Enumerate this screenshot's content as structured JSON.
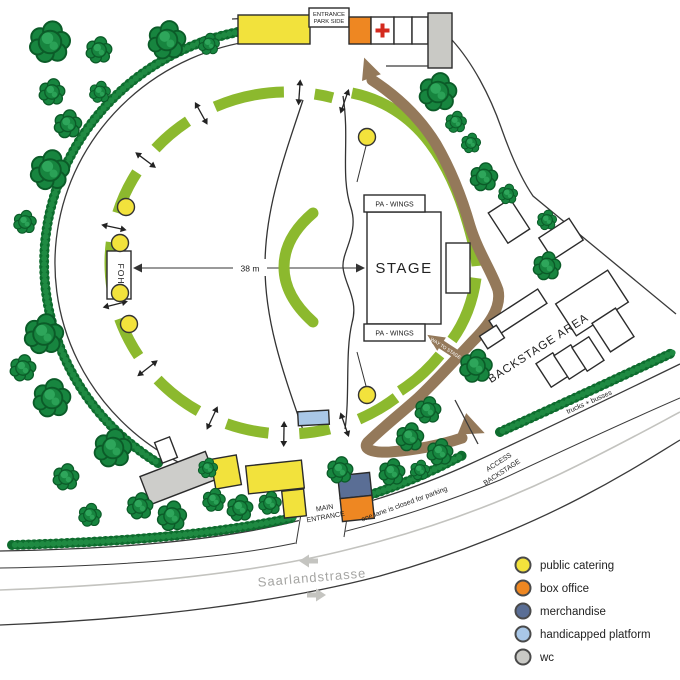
{
  "map": {
    "labels": {
      "entrance_park_side_1": "ENTRANCE",
      "entrance_park_side_2": "PARK SIDE",
      "stage": "STAGE",
      "pa_wings": "PA - WINGS",
      "foh": "FOH",
      "distance": "38 m",
      "way_to_stage": "WAY TO STAGE",
      "backstage_area": "BACKSTAGE AREA",
      "access_backstage_1": "ACCESS",
      "access_backstage_2": "BACKSTAGE",
      "trucks_busses": "trucks + busses",
      "one_lane": "one lane is closed for parking",
      "main_entrance_1": "MAIN",
      "main_entrance_2": "ENTRANCE",
      "street": "Saarlandstrasse"
    },
    "legend": {
      "items": [
        {
          "label": "public catering",
          "color": "#f2e23c"
        },
        {
          "label": "box office",
          "color": "#ee8722"
        },
        {
          "label": "merchandise",
          "color": "#5a6e95"
        },
        {
          "label": "handicapped platform",
          "color": "#a9c7e7"
        },
        {
          "label": "wc",
          "color": "#c9c9c5"
        }
      ]
    }
  }
}
